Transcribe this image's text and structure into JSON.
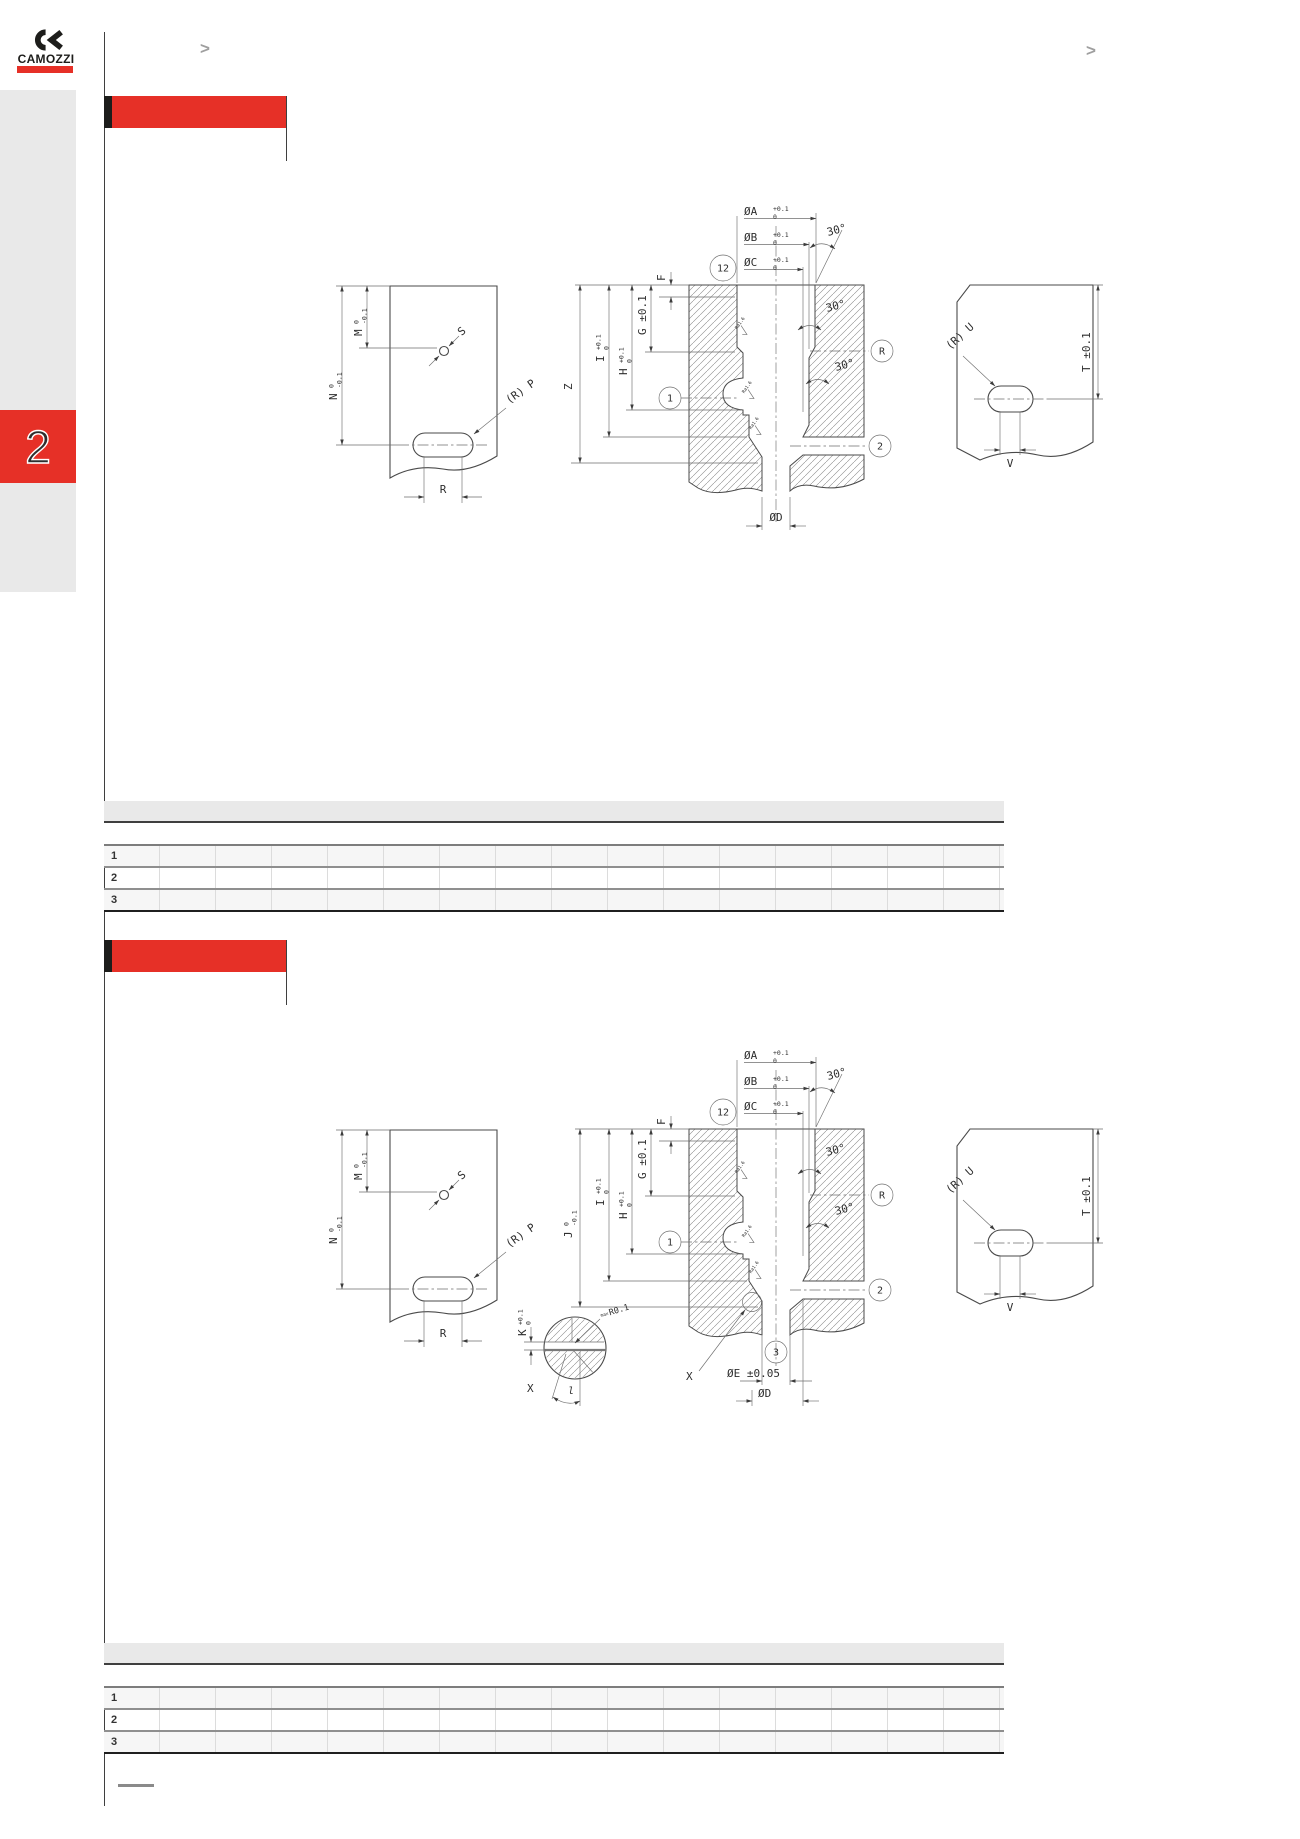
{
  "colors": {
    "accent-red": "#e63027",
    "ink": "#1d1d1b",
    "sidebar-gray": "#e9e9e9",
    "chevron-gray": "#9f9f9f"
  },
  "header": {
    "brand": "CAMOZZI",
    "nav_left": ">",
    "nav_right": ">"
  },
  "sidebar": {
    "section_number": "2"
  },
  "drawing": {
    "dia_a": "ØA",
    "dia_b": "ØB",
    "dia_c": "ØC",
    "dia_d": "ØD",
    "tol_plus": "+0.1",
    "tol_zero": "0",
    "tol_minus": "-0.1",
    "angle_30": "30°",
    "balloon_12": "12",
    "balloon_1": "1",
    "balloon_2": "2",
    "balloon_r": "R",
    "dim_f": "F",
    "dim_g": "G ±0.1",
    "dim_h": "H",
    "dim_i": "I",
    "dim_m": "M",
    "dim_n": "N",
    "dim_r": "R",
    "hole_s": "S",
    "slot_p": "(R) P",
    "slot_u": "(R) U",
    "dim_t": "T ±0.1",
    "dim_v": "V",
    "roughness": "Ra1.6"
  },
  "drawing1": {
    "dim_z": "Z"
  },
  "drawing2": {
    "dim_j": "J",
    "dim_k": "K",
    "dia_e": "ØE ±0.05",
    "balloon_3": "3",
    "detail_ref": "X",
    "angle_l": "l",
    "radius_note_prefix": "max",
    "radius_note": "R0.1"
  },
  "section1": {
    "table": {
      "rows": [
        "1",
        "2",
        "3"
      ]
    }
  },
  "section2": {
    "table": {
      "rows": [
        "1",
        "2",
        "3"
      ]
    }
  }
}
